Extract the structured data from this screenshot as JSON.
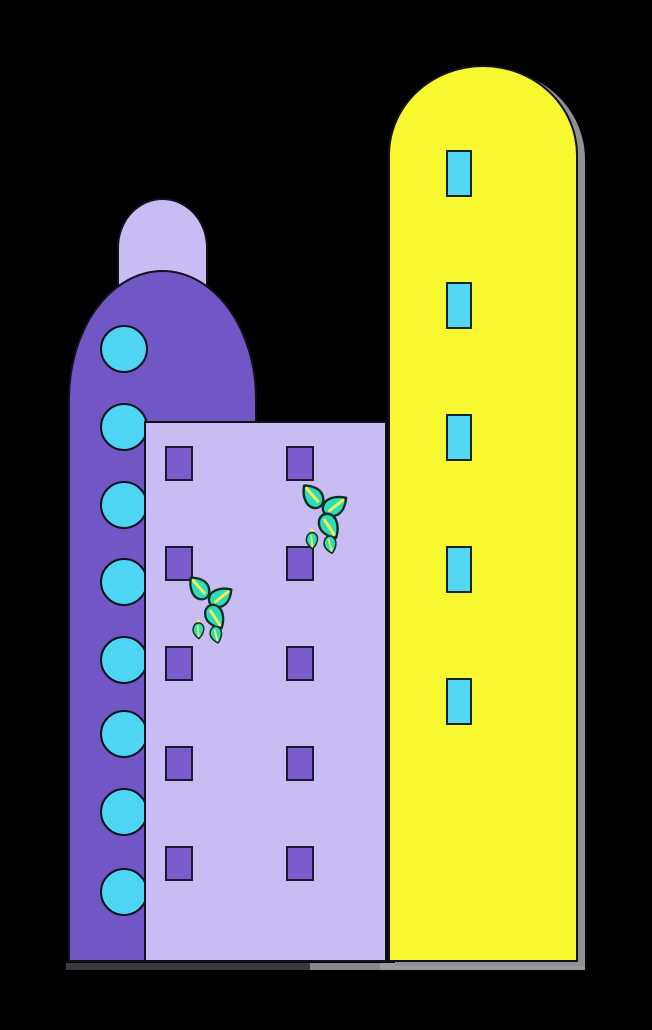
{
  "canvas": {
    "width": 652,
    "height": 1030,
    "background": "#000000",
    "outline_color": "#12121c"
  },
  "rear_dome": {
    "x": 117,
    "y": 198,
    "width": 91,
    "height": 120,
    "color": "#c9bcf2",
    "corner_rx": 46,
    "corner_ry": 50
  },
  "round_tower": {
    "x": 68,
    "y": 270,
    "width": 189,
    "height": 692,
    "color": "#7157c5",
    "corner_rx": 95,
    "corner_ry": 130,
    "portholes": {
      "color": "#4ed5f4",
      "radius": 24,
      "cx": 122,
      "cy_list": [
        347,
        425,
        503,
        580,
        658,
        732,
        810,
        890
      ]
    }
  },
  "yellow_tower": {
    "x": 388,
    "y": 65,
    "width": 190,
    "height": 897,
    "color": "#f8f830",
    "corner_rx": 95,
    "corner_ry": 90,
    "shadow": {
      "offset_x": 7,
      "offset_y": 4,
      "color": "#8f8f94"
    },
    "window_grids": {
      "x": 444,
      "top_y_list": [
        148,
        280,
        412,
        544,
        676
      ],
      "columns": 3,
      "rows": 2,
      "pane_width": 26,
      "pane_height": 47,
      "gap": 2,
      "pane_color": "#53d7f2",
      "pane_border": "#18241f"
    }
  },
  "front_building": {
    "x": 144,
    "y": 421,
    "width": 243,
    "height": 541,
    "color": "#c9bcf2",
    "window_grids": {
      "left_x": 163,
      "right_x": 284,
      "top_y_list": [
        444,
        544,
        644,
        744,
        844
      ],
      "columns": 3,
      "rows": 2,
      "pane_width": 28,
      "pane_height": 35,
      "gap": 3,
      "pane_color": "#7a5ccd",
      "pane_border": "#1a1a30"
    }
  },
  "plants": {
    "leaf_color": "#2edcb7",
    "outline_color": "#0c2e23",
    "vein_color": "#f3ee58",
    "items": [
      {
        "x": 297,
        "y": 477,
        "width": 56,
        "height": 78
      },
      {
        "x": 184,
        "y": 569,
        "width": 54,
        "height": 76
      }
    ]
  },
  "ground_shadow": {
    "y": 963,
    "height": 7,
    "segments": [
      {
        "x": 66,
        "width": 244,
        "color": "#3a3a3e"
      },
      {
        "x": 310,
        "width": 70,
        "color": "#87878c"
      },
      {
        "x": 380,
        "width": 205,
        "color": "#9b9b9f"
      }
    ]
  }
}
